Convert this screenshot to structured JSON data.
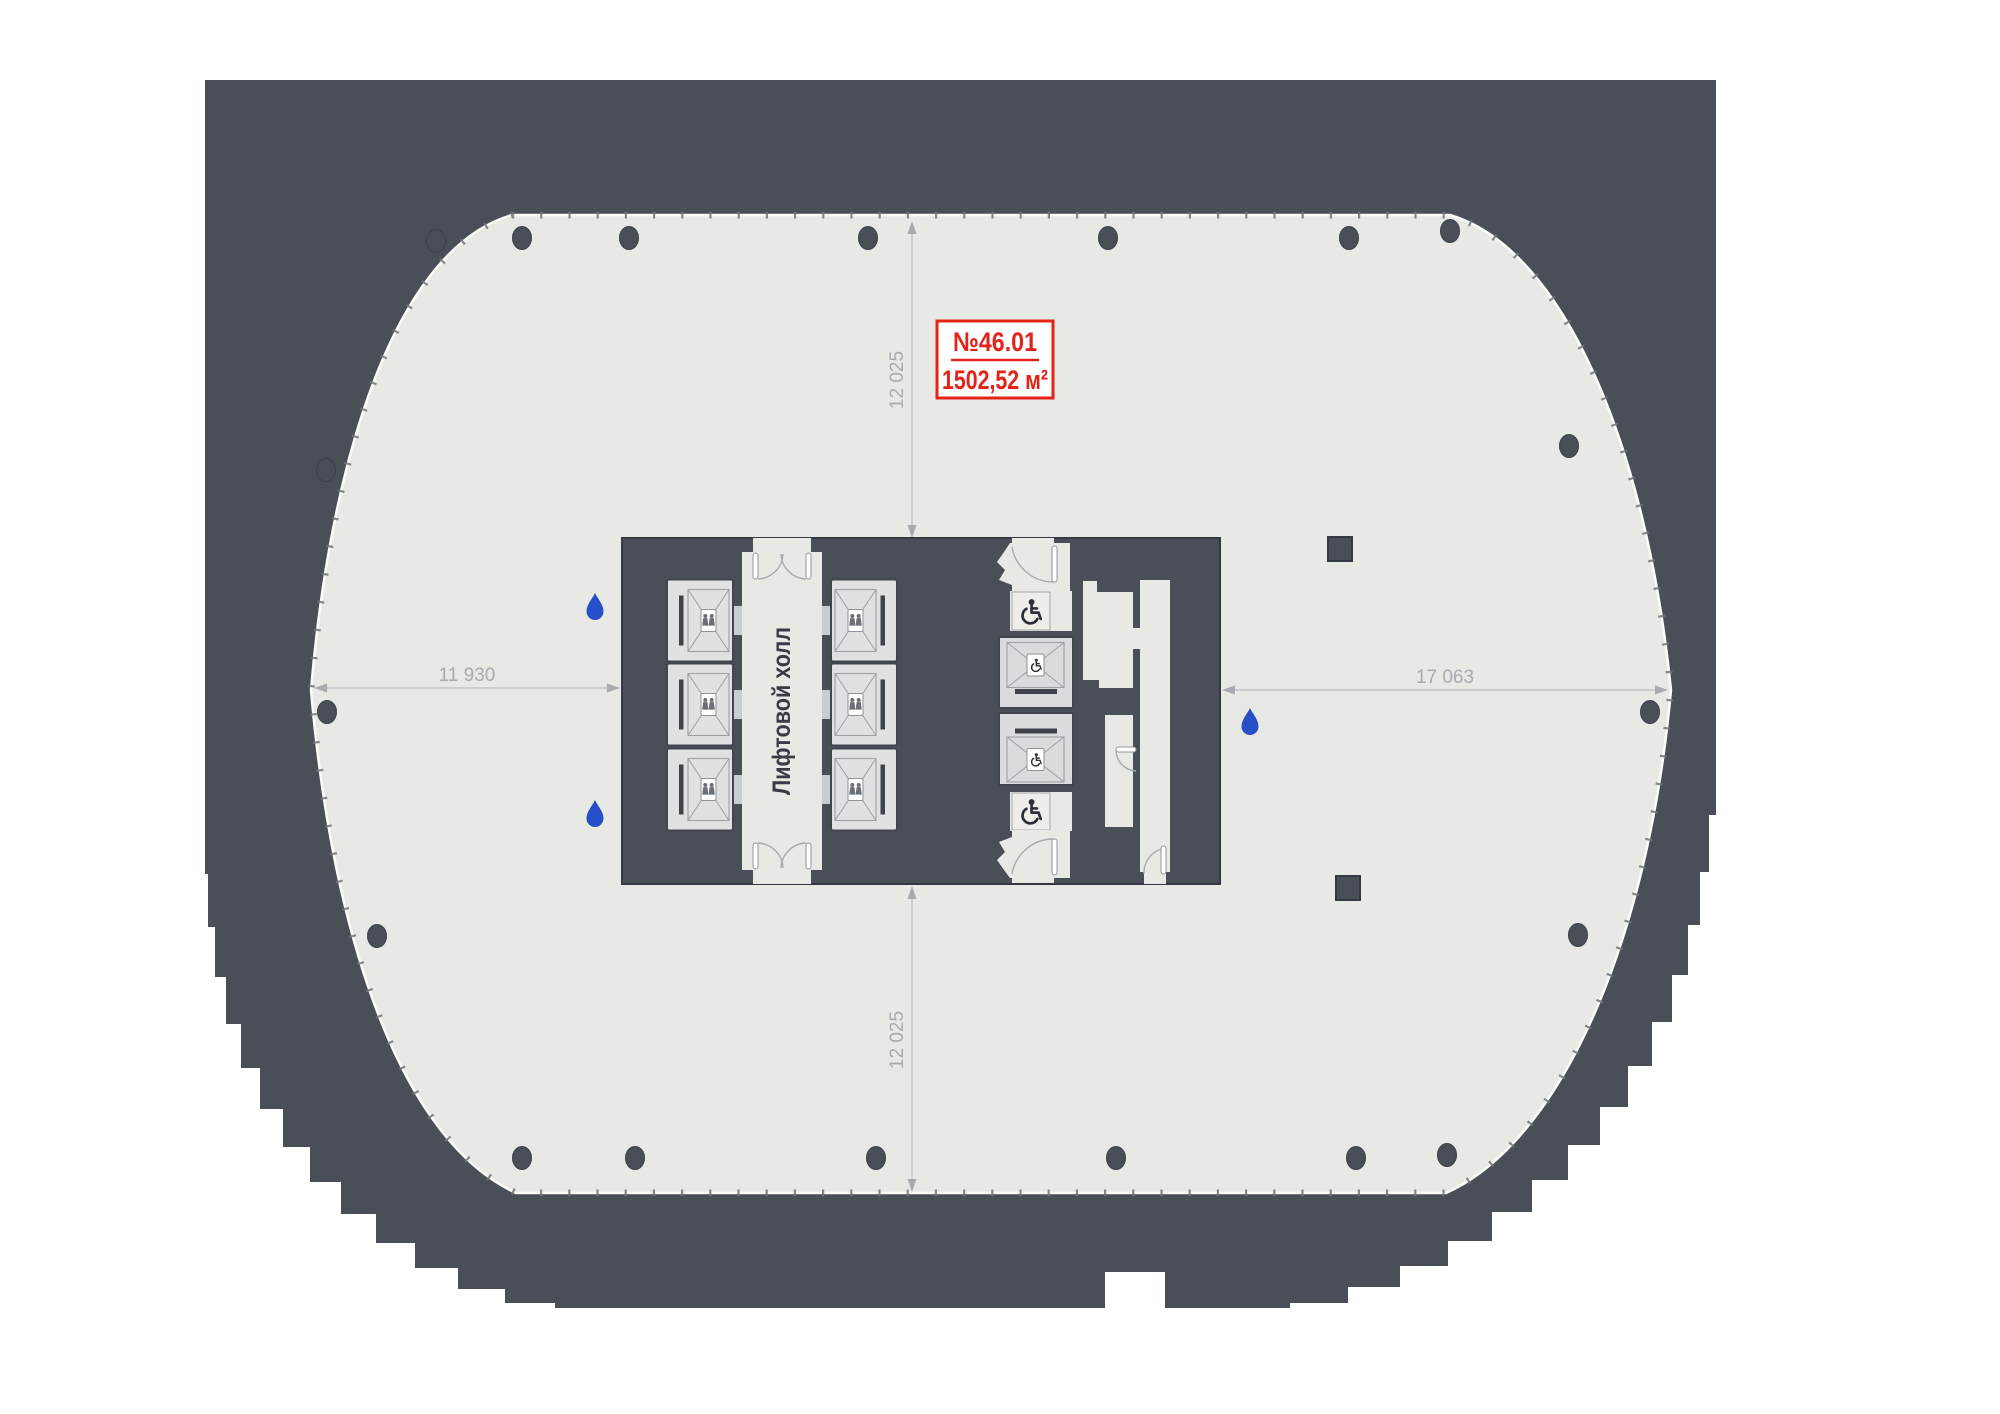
{
  "page": {
    "title": "Floor plan",
    "background": "#ffffff"
  },
  "unit_label": {
    "number": "№46.01",
    "area": "1502,52 м²"
  },
  "dimensions": {
    "top": "12 025",
    "bottom": "12 025",
    "left": "11 930",
    "right": "17 063"
  },
  "labels": {
    "lift_hall": "Лифтовой холл"
  },
  "palette": {
    "building_gray": "#4a4e57",
    "floor_light": "#e8e8e4",
    "accent_red": "#e42319",
    "drop_blue": "#2750c8",
    "dim_gray": "#a7abb0",
    "text_dark": "#393c44"
  },
  "elements": {
    "passenger_elevators": 6,
    "service_elevators": 2,
    "accessible_wc_rooms": 2,
    "water_drop_markers": 3,
    "round_columns": 19,
    "square_columns": 2,
    "icons": [
      "wheelchair-icon",
      "water-drop-icon",
      "elevator-people-icon",
      "door-swing"
    ]
  }
}
